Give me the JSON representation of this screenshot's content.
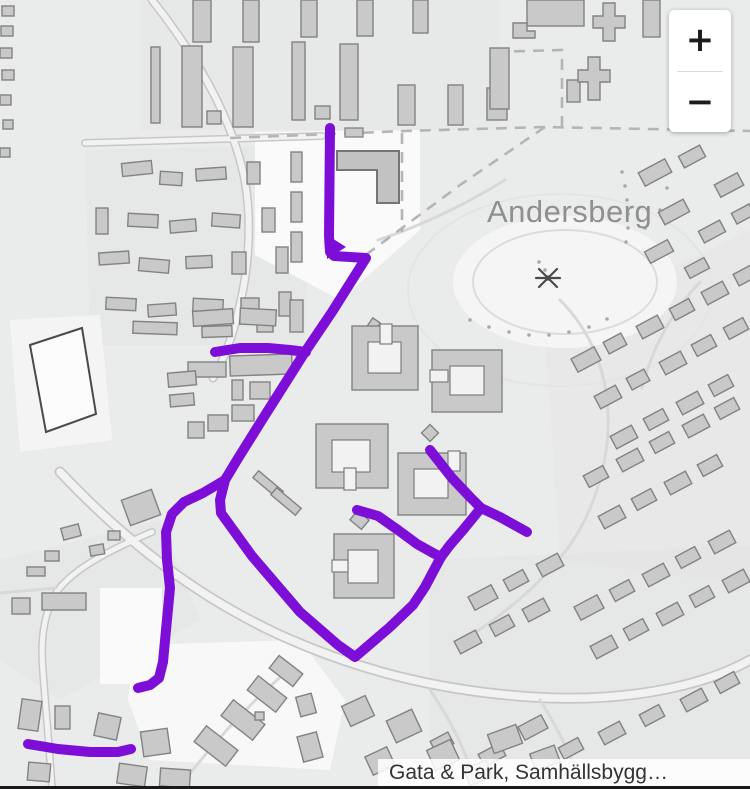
{
  "map": {
    "place_label": "Andersberg",
    "attribution": "Gata & Park, Samhällsbygg…"
  },
  "controls": {
    "zoom_in": "+",
    "zoom_out": "−"
  },
  "route": {
    "color": "#7C0ED7",
    "width": 10,
    "segments": [
      [
        [
          330,
          128
        ],
        [
          329,
          236
        ],
        [
          330,
          252
        ],
        [
          334,
          256
        ],
        [
          366,
          258
        ],
        [
          332,
          312
        ],
        [
          305,
          352
        ],
        [
          262,
          420
        ],
        [
          237,
          460
        ],
        [
          225,
          480
        ],
        [
          220,
          500
        ],
        [
          221,
          513
        ],
        [
          252,
          556
        ],
        [
          300,
          612
        ],
        [
          338,
          645
        ],
        [
          355,
          657
        ],
        [
          390,
          627
        ],
        [
          413,
          605
        ],
        [
          425,
          587
        ],
        [
          434,
          570
        ],
        [
          441,
          557
        ]
      ],
      [
        [
          215,
          352
        ],
        [
          240,
          348
        ],
        [
          268,
          348
        ],
        [
          290,
          350
        ],
        [
          306,
          352
        ]
      ],
      [
        [
          225,
          480
        ],
        [
          203,
          493
        ],
        [
          184,
          502
        ],
        [
          172,
          514
        ],
        [
          166,
          532
        ],
        [
          167,
          560
        ],
        [
          170,
          588
        ],
        [
          166,
          630
        ],
        [
          163,
          662
        ],
        [
          159,
          678
        ],
        [
          150,
          685
        ],
        [
          138,
          688
        ]
      ],
      [
        [
          357,
          510
        ],
        [
          378,
          516
        ],
        [
          398,
          530
        ],
        [
          417,
          544
        ],
        [
          433,
          553
        ],
        [
          441,
          557
        ]
      ],
      [
        [
          430,
          450
        ],
        [
          452,
          478
        ],
        [
          470,
          497
        ],
        [
          481,
          508
        ],
        [
          500,
          517
        ],
        [
          527,
          532
        ]
      ],
      [
        [
          481,
          508
        ],
        [
          463,
          530
        ],
        [
          450,
          545
        ],
        [
          441,
          557
        ]
      ],
      [
        [
          28,
          744
        ],
        [
          58,
          749
        ],
        [
          90,
          752
        ],
        [
          118,
          752
        ],
        [
          131,
          749
        ]
      ]
    ],
    "junction_triangle": [
      [
        327,
        235
      ],
      [
        346,
        247
      ],
      [
        327,
        259
      ]
    ]
  }
}
